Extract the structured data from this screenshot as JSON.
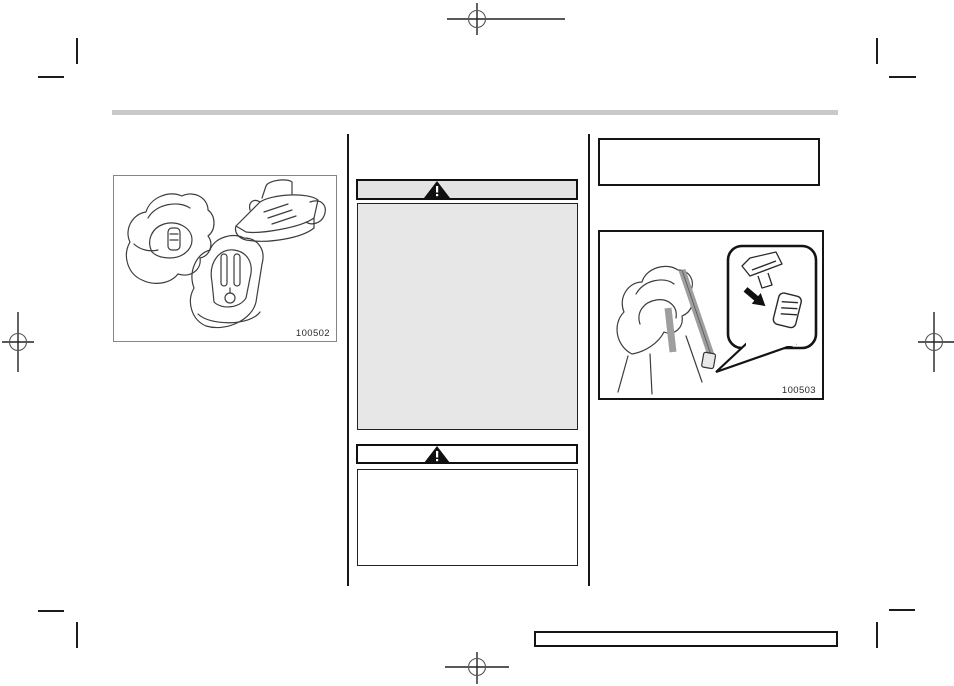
{
  "document": {
    "kind": "owners-manual-scanned-page",
    "page_background": "#ffffff"
  },
  "header": {
    "rule_color": "#c9c9c9"
  },
  "left_column": {
    "figure": {
      "label": "100502",
      "image_name": "child-restraint-types-illustration"
    }
  },
  "middle_column": {
    "warning_box_1": {
      "icon": "warning-triangle-icon",
      "header_fill": "#e3e3e3",
      "body_fill": "#e7e7e7"
    },
    "warning_box_2": {
      "icon": "warning-triangle-icon",
      "header_fill": "#ffffff",
      "body_fill": "#ffffff"
    }
  },
  "right_column": {
    "figure": {
      "label": "100503",
      "image_name": "child-seat-belt-buckle-illustration"
    }
  },
  "print_marks": {
    "names": [
      "crop-mark",
      "registration-target"
    ],
    "ink": "#1c1c1c"
  },
  "colors": {
    "box_border_light": "#858585",
    "box_border_dark": "#141414",
    "belt_gray": "#9e9e9e"
  }
}
